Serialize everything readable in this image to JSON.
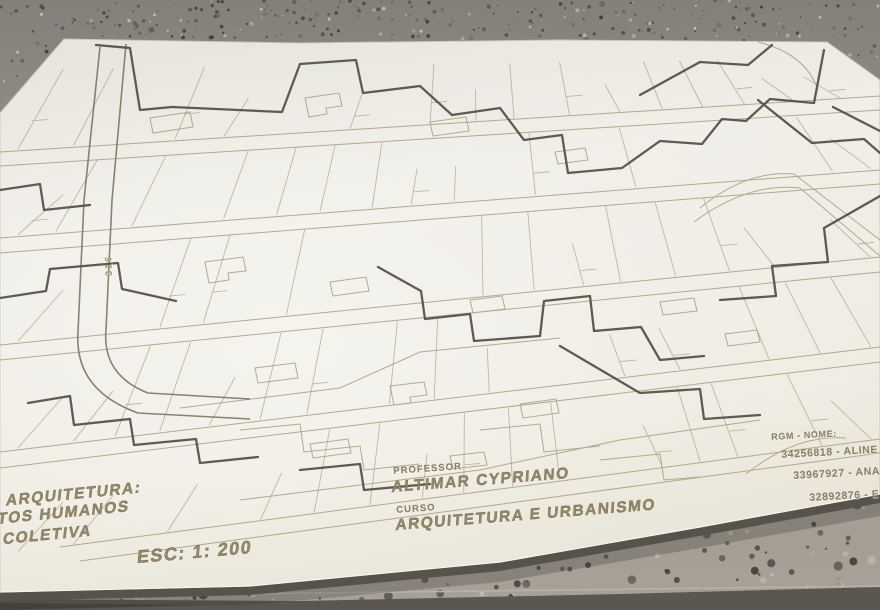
{
  "engravings": {
    "street_number": "316",
    "project_line1": "E ARQUITETURA:",
    "project_line2": "NTOS HUMANOS",
    "project_line3": "COLETIVA",
    "scale": "ESC: 1: 200",
    "professor_label": "PROFESSOR",
    "professor_name": "ALTIMAR CYPRIANO",
    "course_label": "CURSO",
    "course_name": "ARQUITETURA E URBANISMO",
    "roster_header": "RGM - NOME:",
    "roster_1": "34256818 - Aline Ve",
    "roster_2": "33967927 - Ana C",
    "roster_3": "32892876 - E"
  },
  "colors": {
    "board": "#efede5",
    "board_edge_shadow": "#57534b",
    "engraving_faint": "#a89e7b",
    "engraving_medium": "#7e7660",
    "engraving_deep": "#524e45",
    "text": "#8f8566",
    "floor_top": "#87847d",
    "floor_bottom": "#a59f94",
    "floor_dark_band": "#5a5750",
    "speckle_dark": "#45423b",
    "speckle_mid": "#6b675e",
    "speckle_light": "#c6c1b5"
  }
}
